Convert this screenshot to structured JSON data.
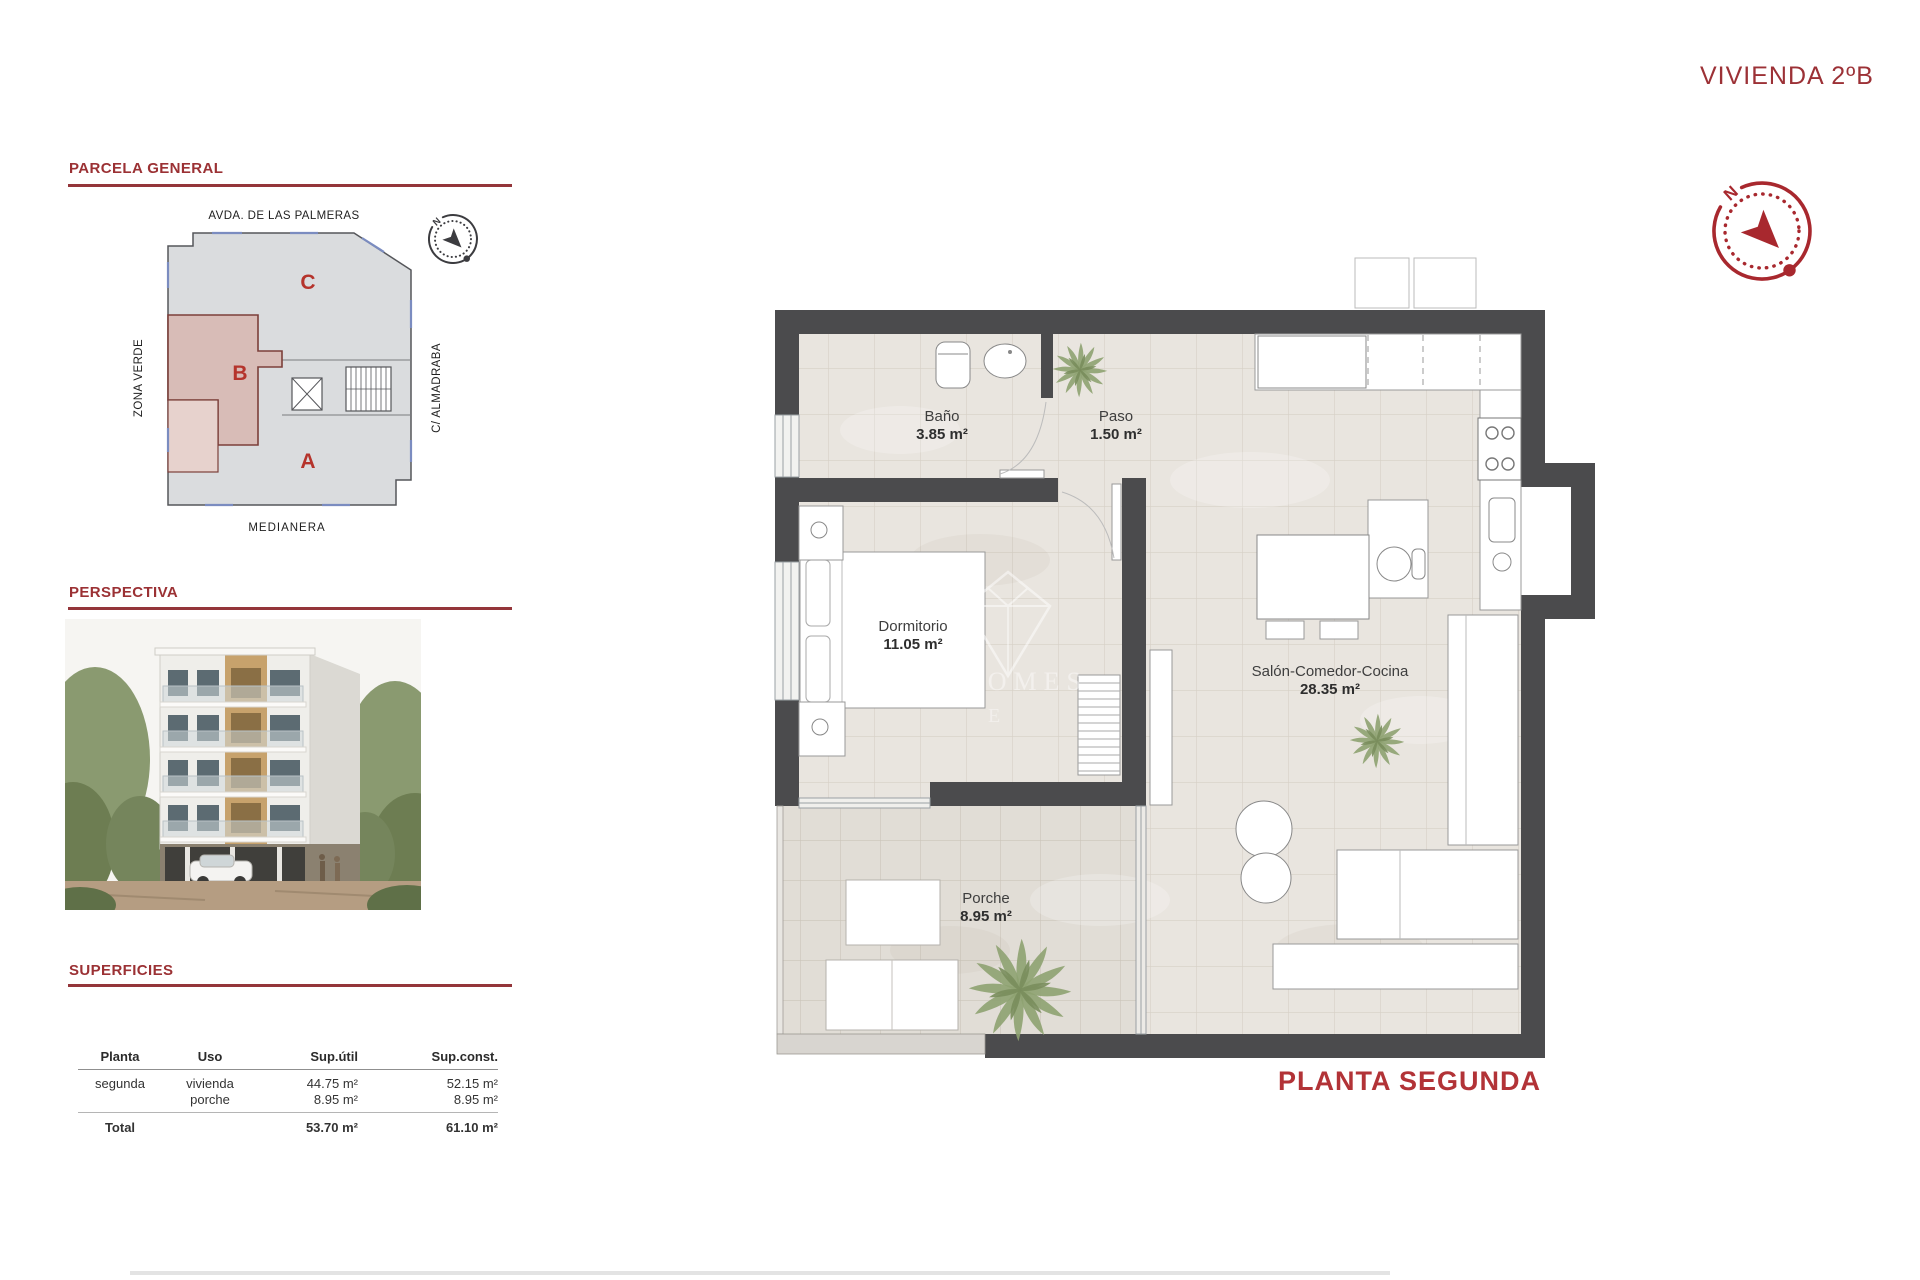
{
  "title": "VIVIENDA 2ºB",
  "caption": "PLANTA SEGUNDA",
  "compass": {
    "label": "N"
  },
  "colors": {
    "accent": "#9b3134",
    "wall": "#4b4b4d",
    "plot_b_fill": "#d8bcb7",
    "plot_gray": "#dadcde"
  },
  "parcela": {
    "heading": "PARCELA GENERAL",
    "street_top": "AVDA. DE LAS PALMERAS",
    "street_left": "ZONA VERDE",
    "street_right": "C/ ALMADRABA",
    "street_bottom": "MEDIANERA",
    "plots": [
      {
        "label": "C"
      },
      {
        "label": "B"
      },
      {
        "label": "A"
      }
    ]
  },
  "perspectiva": {
    "heading": "PERSPECTIVA"
  },
  "superficies": {
    "heading": "SUPERFICIES",
    "table": {
      "headers": [
        "Planta",
        "Uso",
        "Sup.útil",
        "Sup.const."
      ],
      "row": {
        "planta": "segunda",
        "uso1": "vivienda",
        "uso2": "porche",
        "util1": "44.75 m²",
        "util2": "8.95 m²",
        "const1": "52.15 m²",
        "const2": "8.95 m²"
      },
      "total": {
        "label": "Total",
        "util": "53.70 m²",
        "const": "61.10 m²"
      }
    }
  },
  "floorplan": {
    "watermark": "HOMES",
    "rooms": [
      {
        "name": "Baño",
        "area": "3.85 m²"
      },
      {
        "name": "Paso",
        "area": "1.50 m²"
      },
      {
        "name": "Dormitorio",
        "area": "11.05 m²"
      },
      {
        "name": "Salón-Comedor-Cocina",
        "area": "28.35 m²"
      },
      {
        "name": "Porche",
        "area": "8.95 m²"
      }
    ]
  }
}
